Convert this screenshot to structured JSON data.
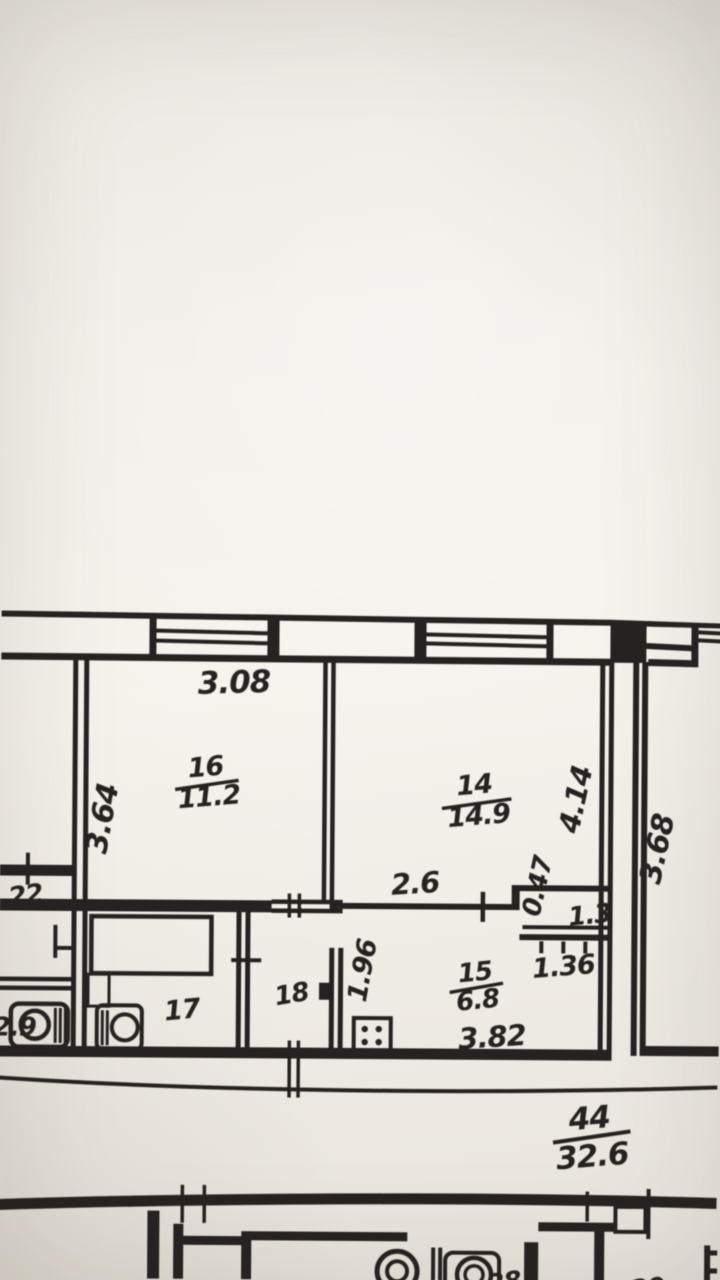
{
  "plan": {
    "apartment": {
      "number": "44",
      "total_area": "32.6"
    },
    "rooms": {
      "r16": {
        "number": "16",
        "area": "11.2",
        "dim_width": "3.08",
        "dim_depth": "3.64"
      },
      "r14": {
        "number": "14",
        "area": "14.9",
        "dim_depth": "4.14",
        "dim_opening": "2.6",
        "dim_niche_depth": "0.47",
        "dim_niche_width": "1.3"
      },
      "r15": {
        "number": "15",
        "area": "6.8",
        "dim_width": "3.82",
        "dim_depth": "1.96",
        "dim_duct": "1.36"
      },
      "r17": {
        "number": "17"
      },
      "r18": {
        "number": "18"
      }
    },
    "neighbors": {
      "right_room_dim": "3.68",
      "left_room_number": "22",
      "left_room_dim": "2.9",
      "bottom_room_a": "28",
      "bottom_room_b": "20"
    }
  }
}
